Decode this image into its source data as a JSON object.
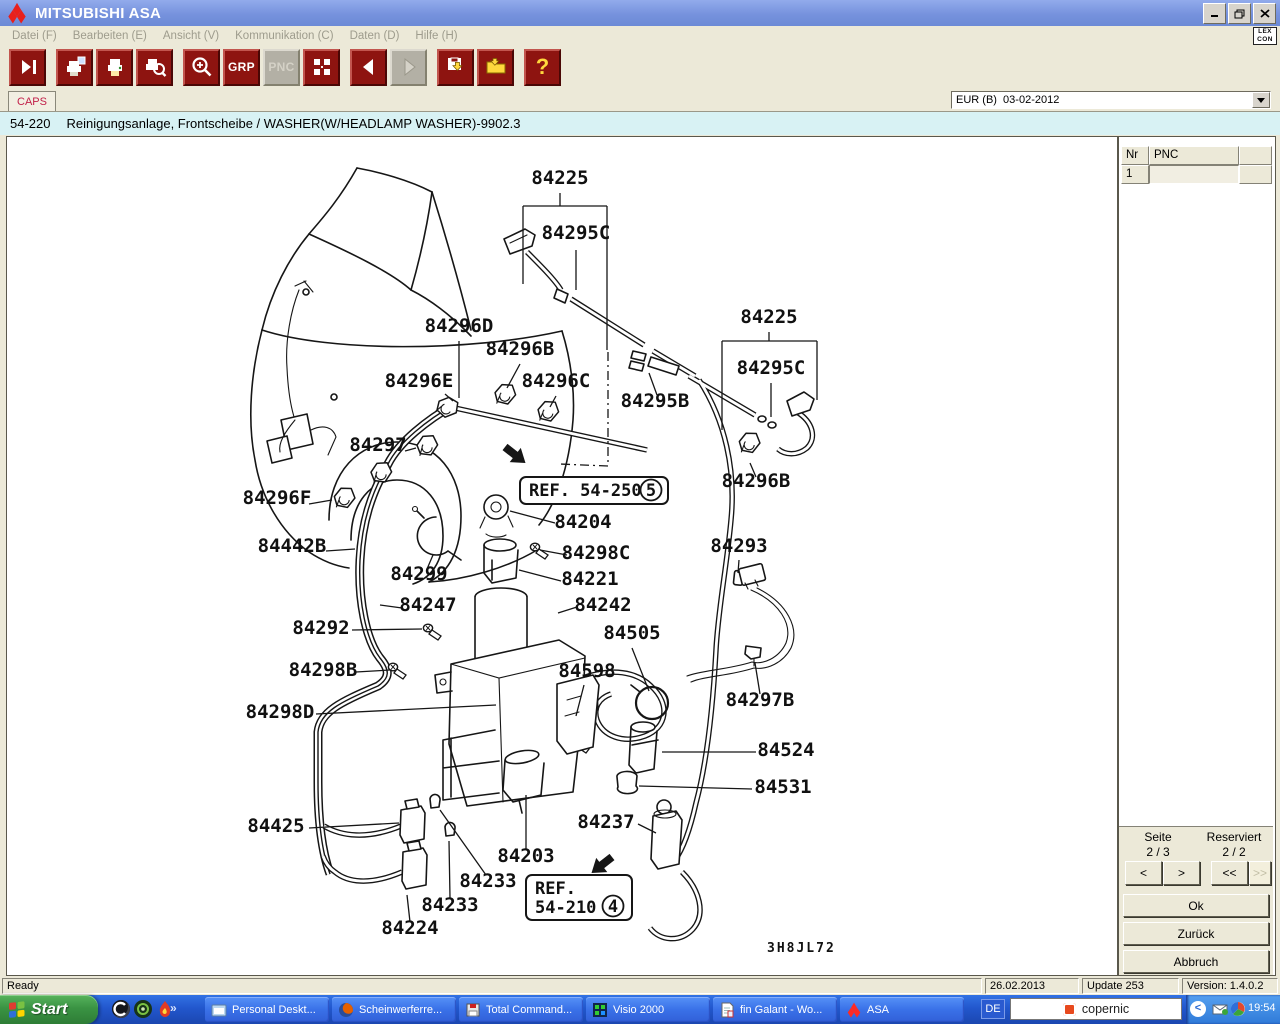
{
  "window": {
    "title": "MITSUBISHI ASA"
  },
  "menu": {
    "items": [
      {
        "id": "datei",
        "label": "Datei (F)"
      },
      {
        "id": "bearbeiten",
        "label": "Bearbeiten (E)"
      },
      {
        "id": "ansicht",
        "label": "Ansicht (V)"
      },
      {
        "id": "kommunikation",
        "label": "Kommunikation (C)"
      },
      {
        "id": "daten",
        "label": "Daten (D)"
      },
      {
        "id": "hilfe",
        "label": "Hilfe (H)"
      }
    ],
    "lexcon_line1": "LEX",
    "lexcon_line2": "CON"
  },
  "toolbar": {
    "grp_label": "GRP",
    "pnc_label": "PNC",
    "help_label": "?"
  },
  "tabs": {
    "caps": "CAPS"
  },
  "region_select": {
    "value": "EUR (B)  03-02-2012"
  },
  "breadcrumb": {
    "code": "54-220",
    "title": "Reinigungsanlage, Frontscheibe / WASHER(W/HEADLAMP WASHER)-9902.3"
  },
  "parts_table": {
    "columns": [
      "Nr",
      "PNC"
    ],
    "rows": [
      {
        "nr": "1",
        "pnc": ""
      }
    ]
  },
  "pager": {
    "seite_label": "Seite",
    "seite_value": "2 / 3",
    "reserviert_label": "Reserviert",
    "reserviert_value": "2 / 2",
    "prev": "<",
    "next": ">",
    "first": "<<",
    "last": ">>",
    "ok": "Ok",
    "back": "Zurück",
    "cancel": "Abbruch"
  },
  "statusbar": {
    "ready": "Ready",
    "date": "26.02.2013",
    "update": "Update 253",
    "version": "Version: 1.4.0.2"
  },
  "taskbar": {
    "start": "Start",
    "quicklaunch_more": "»",
    "tasks": [
      {
        "label": "Personal Deskt..."
      },
      {
        "label": "Scheinwerferre..."
      },
      {
        "label": "Total Command..."
      },
      {
        "label": "Visio 2000"
      },
      {
        "label": "fin Galant - Wo..."
      },
      {
        "label": "ASA"
      }
    ],
    "tray": {
      "lang": "DE",
      "search": "copernic",
      "chevron": "<",
      "clock": "19:54"
    }
  },
  "diagram": {
    "plate_code": "3H8JL72",
    "labels": [
      {
        "text": "84225",
        "x": 561,
        "y": 184
      },
      {
        "text": "84295C",
        "x": 577,
        "y": 239
      },
      {
        "text": "84296D",
        "x": 460,
        "y": 332
      },
      {
        "text": "84296B",
        "x": 521,
        "y": 355
      },
      {
        "text": "84296E",
        "x": 420,
        "y": 387
      },
      {
        "text": "84296C",
        "x": 557,
        "y": 387
      },
      {
        "text": "84225",
        "x": 770,
        "y": 323
      },
      {
        "text": "84295C",
        "x": 772,
        "y": 374
      },
      {
        "text": "84295B",
        "x": 656,
        "y": 407
      },
      {
        "text": "84297",
        "x": 379,
        "y": 451
      },
      {
        "text": "84296B",
        "x": 757,
        "y": 487
      },
      {
        "text": "84296F",
        "x": 278,
        "y": 504
      },
      {
        "text": "84204",
        "x": 584,
        "y": 528
      },
      {
        "text": "84442B",
        "x": 293,
        "y": 552
      },
      {
        "text": "84298C",
        "x": 597,
        "y": 559
      },
      {
        "text": "84299",
        "x": 420,
        "y": 580
      },
      {
        "text": "84221",
        "x": 591,
        "y": 585
      },
      {
        "text": "84293",
        "x": 740,
        "y": 552
      },
      {
        "text": "84247",
        "x": 429,
        "y": 611
      },
      {
        "text": "84242",
        "x": 604,
        "y": 611
      },
      {
        "text": "84292",
        "x": 322,
        "y": 634
      },
      {
        "text": "84505",
        "x": 633,
        "y": 639
      },
      {
        "text": "84598",
        "x": 588,
        "y": 677
      },
      {
        "text": "84298B",
        "x": 324,
        "y": 676
      },
      {
        "text": "84297B",
        "x": 761,
        "y": 706
      },
      {
        "text": "84298D",
        "x": 281,
        "y": 718
      },
      {
        "text": "84524",
        "x": 787,
        "y": 756
      },
      {
        "text": "84531",
        "x": 784,
        "y": 793
      },
      {
        "text": "84425",
        "x": 277,
        "y": 832
      },
      {
        "text": "84237",
        "x": 607,
        "y": 828
      },
      {
        "text": "84203",
        "x": 527,
        "y": 862
      },
      {
        "text": "84233",
        "x": 489,
        "y": 887
      },
      {
        "text": "84233",
        "x": 451,
        "y": 911
      },
      {
        "text": "84224",
        "x": 411,
        "y": 934
      }
    ],
    "refs": [
      {
        "lines": [
          "REF. 54-250"
        ],
        "num": "5",
        "x": 521,
        "y": 477,
        "w": 148,
        "h": 27,
        "num_cx": 652,
        "num_cy": 490
      },
      {
        "lines": [
          "REF.",
          "54-210"
        ],
        "num": "4",
        "x": 527,
        "y": 875,
        "w": 106,
        "h": 45,
        "num_cx": 614,
        "num_cy": 906
      }
    ]
  },
  "colors": {
    "titlebar_blue": "#7692dd",
    "toolbar_red": "#8e1410",
    "caps_red": "#c22049",
    "breadcrumb_bg": "#d8f2f4",
    "taskbar_blue": "#2257cd",
    "start_green": "#3a9343"
  }
}
